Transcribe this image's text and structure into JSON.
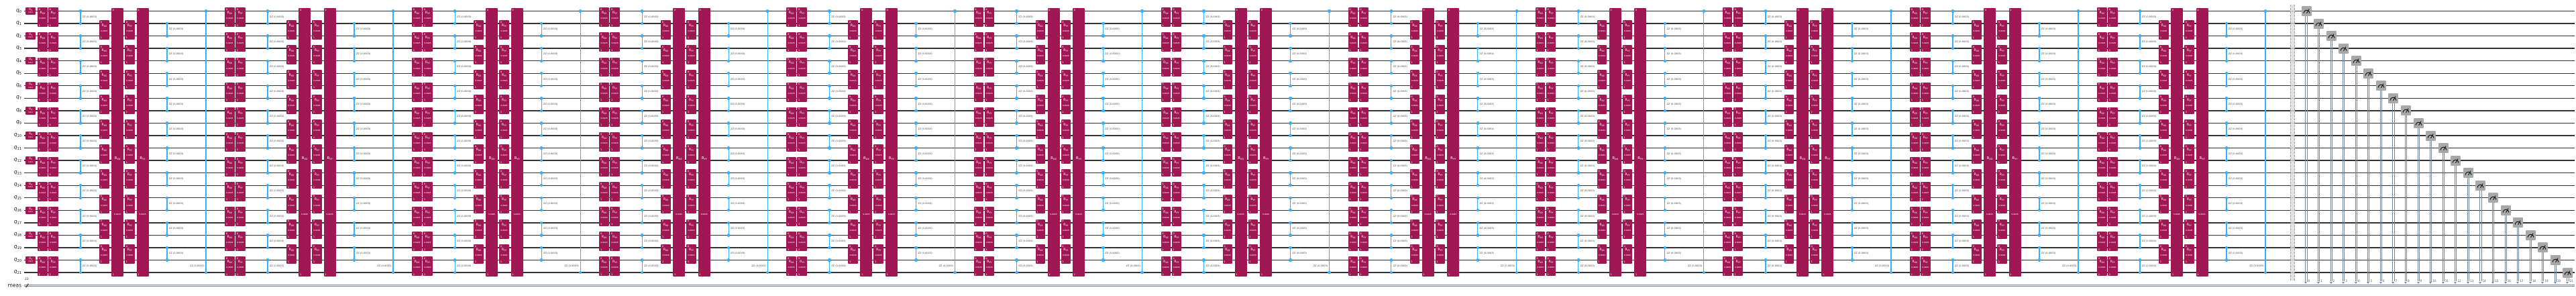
{
  "diagram_type": "quantum-circuit",
  "qubits": {
    "prefix": "q",
    "indices": [
      "0",
      "1",
      "2",
      "3",
      "4",
      "5",
      "6",
      "7",
      "8",
      "9",
      "10",
      "11",
      "12",
      "13",
      "14",
      "15",
      "16",
      "17",
      "18",
      "19",
      "20",
      "21"
    ]
  },
  "classical_register": {
    "label": "meas",
    "size": "22"
  },
  "clbit_indices": [
    "0",
    "1",
    "2",
    "3",
    "4",
    "5",
    "6",
    "7",
    "8",
    "9",
    "10",
    "11",
    "12",
    "13",
    "14",
    "15",
    "16",
    "17",
    "18",
    "19",
    "20",
    "21"
  ],
  "trotter_blocks": 12,
  "gates": {
    "u3": {
      "name": "U",
      "subscript": "3",
      "params": "π,0,π"
    },
    "rxx": {
      "name": "R",
      "subscript": "XX",
      "param": "0.0025"
    },
    "ryy": {
      "name": "R",
      "subscript": "YY",
      "param": "0.0025"
    },
    "rzz_label": "ZZ (0.0003)",
    "endpoint_top": "0",
    "endpoint_bottom": "1"
  },
  "colors": {
    "gate_fill": "#9F1853",
    "gate_text": "#ffffff",
    "rzz_blue": "#33B1FF",
    "wire": "#343434",
    "classical_wire": "#778899",
    "measure_fill": "#A8A8A8",
    "measure_glyph": "#111111",
    "barrier_fill": "#dcdcdc",
    "barrier_edge": "#8a8a8a",
    "label_text": "#1a1a1a",
    "zz_label_text": "#3c3c3c",
    "background": "#ffffff"
  }
}
